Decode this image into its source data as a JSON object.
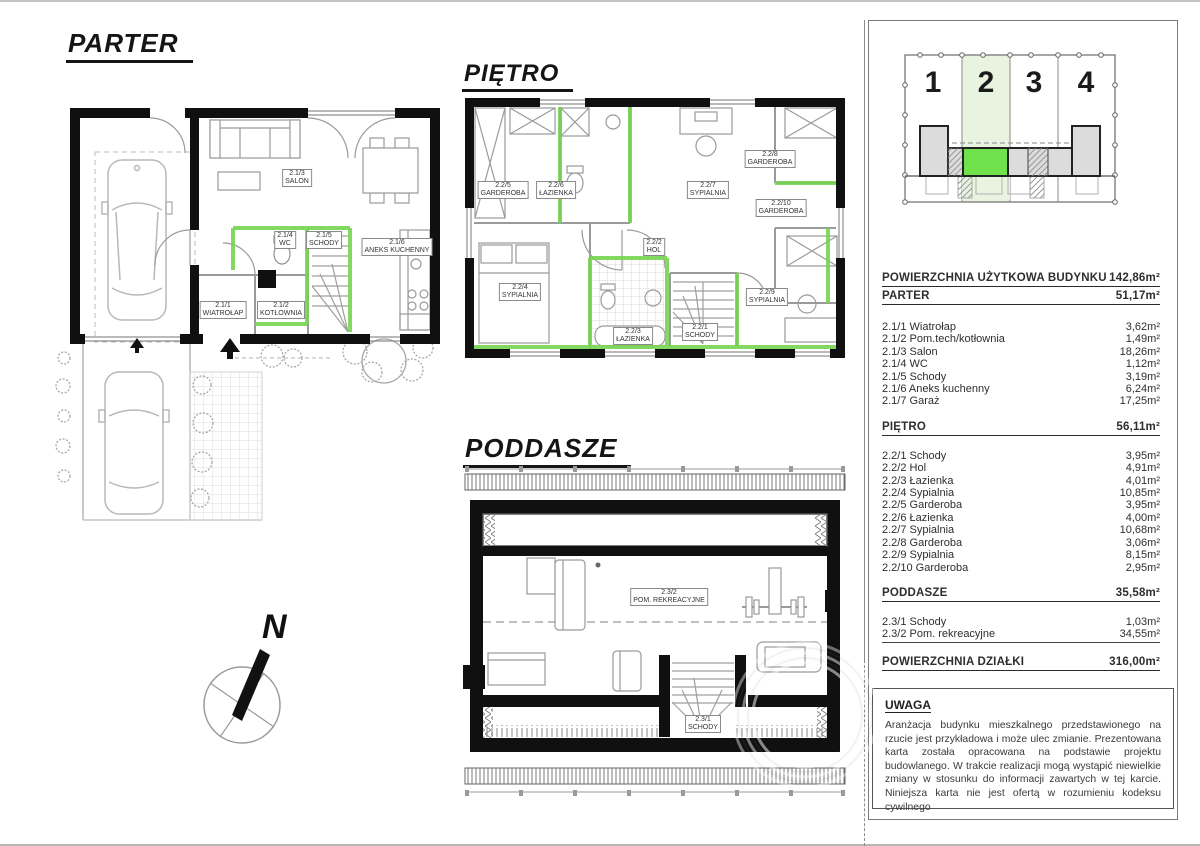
{
  "plans": {
    "parter": {
      "title": "PARTER",
      "rooms": [
        {
          "code": "2.1/1",
          "name": "WIATROŁAP"
        },
        {
          "code": "2.1/2",
          "name": "KOTŁOWNIA"
        },
        {
          "code": "2.1/3",
          "name": "SALON"
        },
        {
          "code": "2.1/4",
          "name": "WC"
        },
        {
          "code": "2.1/5",
          "name": "SCHODY"
        },
        {
          "code": "2.1/6",
          "name": "ANEKS KUCHENNY"
        }
      ]
    },
    "pietro": {
      "title": "PIĘTRO",
      "rooms": [
        {
          "code": "2.2/1",
          "name": "SCHODY"
        },
        {
          "code": "2.2/2",
          "name": "HOL"
        },
        {
          "code": "2.2/3",
          "name": "ŁAZIENKA"
        },
        {
          "code": "2.2/4",
          "name": "SYPIALNIA"
        },
        {
          "code": "2.2/5",
          "name": "GARDEROBA"
        },
        {
          "code": "2.2/6",
          "name": "ŁAZIENKA"
        },
        {
          "code": "2.2/7",
          "name": "SYPIALNIA"
        },
        {
          "code": "2.2/8",
          "name": "GARDEROBA"
        },
        {
          "code": "2.2/9",
          "name": "SYPIALNIA"
        },
        {
          "code": "2.2/10",
          "name": "GARDEROBA"
        }
      ]
    },
    "poddasze": {
      "title": "PODDASZE",
      "rooms": [
        {
          "code": "2.3/1",
          "name": "SCHODY"
        },
        {
          "code": "2.3/2",
          "name": "POM. REKREACYJNE"
        }
      ]
    }
  },
  "compass": {
    "north_label": "N"
  },
  "site_diagram": {
    "units": [
      "1",
      "2",
      "3",
      "4"
    ],
    "highlighted_unit": "2",
    "colors": {
      "highlight_fill": "#6fe24b",
      "plot_tint": "#e8f4e0",
      "building_gray": "#dcdcdc"
    }
  },
  "summary": {
    "rows": [
      {
        "label": "POWIERZCHNIA UŻYTKOWA BUDYNKU",
        "value": "142,86m²"
      },
      {
        "label": "PARTER",
        "value": "51,17m²"
      },
      {
        "label": "2.1/1 Wiatrołap",
        "value": "3,62m²"
      },
      {
        "label": "2.1/2 Pom.tech/kotłownia",
        "value": "1,49m²"
      },
      {
        "label": "2.1/3 Salon",
        "value": "18,26m²"
      },
      {
        "label": "2.1/4 WC",
        "value": "1,12m²"
      },
      {
        "label": "2.1/5 Schody",
        "value": "3,19m²"
      },
      {
        "label": "2.1/6 Aneks kuchenny",
        "value": "6,24m²"
      },
      {
        "label": "2.1/7 Garaż",
        "value": "17,25m²"
      },
      {
        "label": "PIĘTRO",
        "value": "56,11m²"
      },
      {
        "label": "2.2/1 Schody",
        "value": "3,95m²"
      },
      {
        "label": "2.2/2 Hol",
        "value": "4,91m²"
      },
      {
        "label": "2.2/3 Łazienka",
        "value": "4,01m²"
      },
      {
        "label": "2.2/4 Sypialnia",
        "value": "10,85m²"
      },
      {
        "label": "2.2/5 Garderoba",
        "value": "3,95m²"
      },
      {
        "label": "2.2/6 Łazienka",
        "value": "4,00m²"
      },
      {
        "label": "2.2/7 Sypialnia",
        "value": "10,68m²"
      },
      {
        "label": "2.2/8 Garderoba",
        "value": "3,06m²"
      },
      {
        "label": "2.2/9 Sypialnia",
        "value": "8,15m²"
      },
      {
        "label": "2.2/10 Garderoba",
        "value": "2,95m²"
      },
      {
        "label": "PODDASZE",
        "value": "35,58m²"
      },
      {
        "label": "2.3/1 Schody",
        "value": "1,03m²"
      },
      {
        "label": "2.3/2 Pom. rekreacyjne",
        "value": "34,55m²"
      },
      {
        "label": "POWIERZCHNIA DZIAŁKI",
        "value": "316,00m²"
      }
    ]
  },
  "note": {
    "title": "UWAGA",
    "body": "Aranżacja budynku mieszkalnego przedstawionego na rzucie jest przykładowa i może ulec zmianie. Prezentowana karta została opracowana na podstawie projektu budowlanego. W trakcie realizacji mogą wystąpić niewielkie zmiany w stosunku do informacji zawartych w tej karcie. Niniejsza karta nie jest ofertą w rozumieniu kodeksu cywilnego"
  },
  "colors": {
    "wall": "#101010",
    "green_accent": "#76d450"
  }
}
